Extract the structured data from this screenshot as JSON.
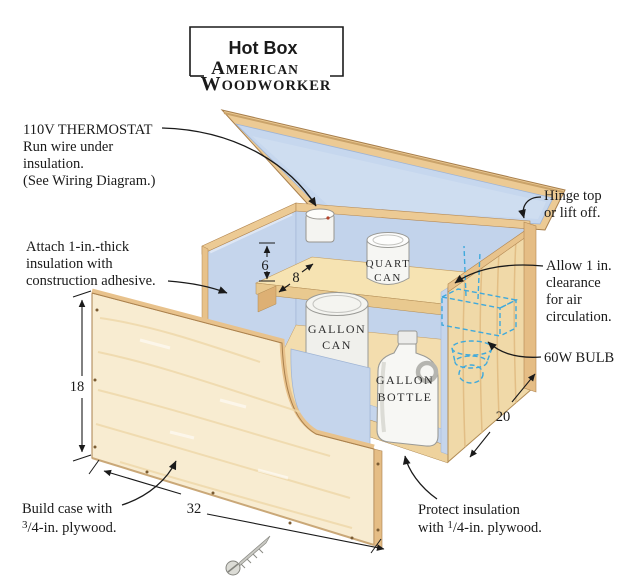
{
  "header": {
    "title": "Hot Box",
    "brand": {
      "a": "A",
      "merican": "MERICAN",
      "w": "W",
      "oodworker": "OODWORKER"
    }
  },
  "callouts": {
    "thermostat": {
      "line1": "110V THERMOSTAT",
      "line2": "Run wire under",
      "line3": "insulation.",
      "line4": "(See Wiring Diagram.)"
    },
    "attach": {
      "line1": "Attach 1-in.-thick",
      "line2": "insulation with",
      "line3": "construction adhesive."
    },
    "build": {
      "line1": "Build case with",
      "sup": "3",
      "line2": "/4-in. plywood."
    },
    "hinge": {
      "line1": "Hinge top",
      "line2": "or lift off."
    },
    "allow": {
      "line1": "Allow 1 in.",
      "line2": "clearance",
      "line3": "for air",
      "line4": "circulation."
    },
    "bulb": {
      "label": "60W BULB"
    },
    "protect": {
      "line1": "Protect insulation",
      "pre": "with ",
      "sup": "1",
      "line2": "/4-in. plywood."
    }
  },
  "contents": {
    "quart_can": {
      "line1": "QUART",
      "line2": "CAN"
    },
    "gallon_can": {
      "line1": "GALLON",
      "line2": "CAN"
    },
    "gallon_bottle": {
      "line1": "GALLON",
      "line2": "BOTTLE"
    }
  },
  "dimensions": {
    "case_height": "18",
    "case_width": "32",
    "case_depth": "20",
    "thermostat_to_shelf": "6",
    "shelf_setback": "8"
  },
  "colors": {
    "plywood_face": "#f8ecd1",
    "wood_edge": "#e8c28c",
    "wood_rail": "#ecca94",
    "insulation_blue": "#c5d5ec",
    "hidden_line_blue": "#3fa9dc",
    "ink": "#1a1a1a"
  }
}
